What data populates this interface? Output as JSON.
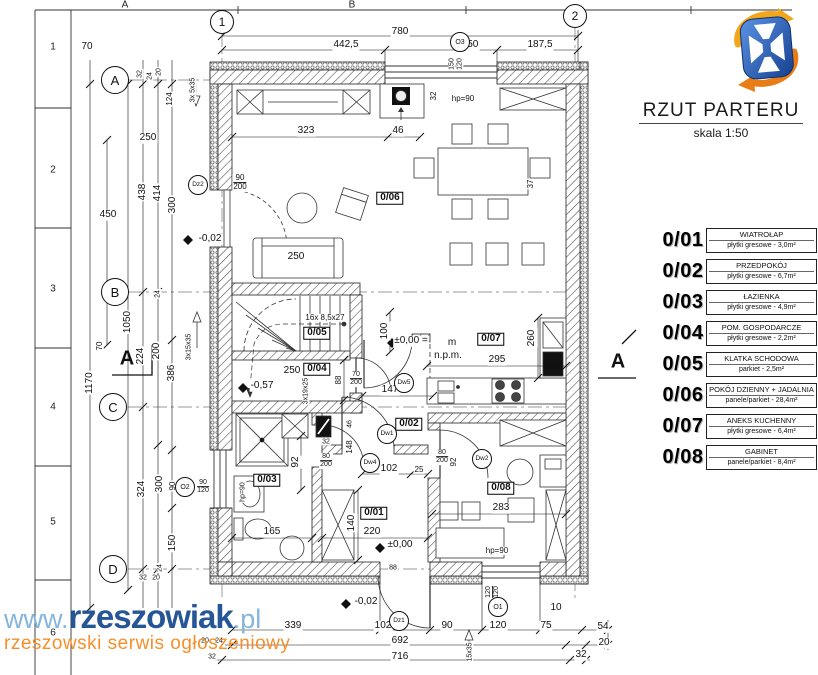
{
  "title_block": {
    "title": "RZUT PARTERU",
    "scale": "skala 1:50"
  },
  "watermark": {
    "www": "www.",
    "name": "rzeszowiak",
    "tld": ".pl",
    "tagline": "rzeszowski serwis ogłoszeniowy"
  },
  "colors": {
    "watermark_blue": "#1b4e91",
    "watermark_light": "#7fb2da",
    "watermark_orange": "#f68a1e",
    "logo_blue_dark": "#16408f",
    "logo_blue_light": "#5b92e5",
    "logo_yellow": "#f2a71b",
    "logo_orange": "#e87d15"
  },
  "legend": {
    "rooms": [
      {
        "id": "0/01",
        "name": "WIATROŁAP",
        "finish": "płytki gresowe - 3,0m²"
      },
      {
        "id": "0/02",
        "name": "PRZEDPOKÓJ",
        "finish": "płytki gresowe - 6,7m²"
      },
      {
        "id": "0/03",
        "name": "ŁAZIENKA",
        "finish": "płytki gresowe - 4,9m²"
      },
      {
        "id": "0/04",
        "name": "POM. GOSPODARCZE",
        "finish": "płytki gresowe - 2,2m²"
      },
      {
        "id": "0/05",
        "name": "KLATKA SCHODOWA",
        "finish": "parkiet - 2,5m²"
      },
      {
        "id": "0/06",
        "name": "POKÓJ DZIENNY + JADALNIA",
        "finish": "panele/parkiet - 28,4m²"
      },
      {
        "id": "0/07",
        "name": "ANEKS KUCHENNY",
        "finish": "płytki gresowe - 6,4m²"
      },
      {
        "id": "0/08",
        "name": "GABINET",
        "finish": "panele/parkiet - 8,4m²"
      }
    ]
  },
  "frame": {
    "top_letters": [
      {
        "t": "A",
        "x": 125
      },
      {
        "t": "B",
        "x": 352
      }
    ],
    "left_numbers": [
      {
        "t": "1",
        "y": 47
      },
      {
        "t": "2",
        "y": 170
      },
      {
        "t": "3",
        "y": 289
      },
      {
        "t": "4",
        "y": 407
      },
      {
        "t": "5",
        "y": 522
      },
      {
        "t": "6",
        "y": 633
      }
    ]
  },
  "plan": {
    "circles": [
      {
        "l": "A",
        "x": 115,
        "y": 80,
        "r": 13,
        "s": 13
      },
      {
        "l": "B",
        "x": 115,
        "y": 292,
        "r": 13,
        "s": 13
      },
      {
        "l": "C",
        "x": 113,
        "y": 407,
        "r": 13,
        "s": 13
      },
      {
        "l": "D",
        "x": 113,
        "y": 569,
        "r": 13,
        "s": 13
      },
      {
        "l": "1",
        "x": 222,
        "y": 22,
        "r": 11,
        "s": 12
      },
      {
        "l": "2",
        "x": 575,
        "y": 16,
        "r": 11,
        "s": 12
      },
      {
        "l": "O3",
        "x": 460,
        "y": 42,
        "r": 9,
        "s": 7
      },
      {
        "l": "O1",
        "x": 498,
        "y": 607,
        "r": 9,
        "s": 7
      },
      {
        "l": "O2",
        "x": 185,
        "y": 487,
        "r": 9,
        "s": 7
      },
      {
        "l": "Dz1",
        "x": 399,
        "y": 621,
        "r": 9,
        "s": 6.5
      },
      {
        "l": "Dz2",
        "x": 198,
        "y": 185,
        "r": 9,
        "s": 6.5
      },
      {
        "l": "Dw1",
        "x": 387,
        "y": 434,
        "r": 9,
        "s": 6.5
      },
      {
        "l": "Dw2",
        "x": 482,
        "y": 459,
        "r": 9,
        "s": 6.5
      },
      {
        "l": "Dw4",
        "x": 370,
        "y": 463,
        "r": 9,
        "s": 6.5
      },
      {
        "l": "Dw5",
        "x": 404,
        "y": 383,
        "r": 9,
        "s": 6.5
      }
    ],
    "labels": [
      {
        "t": "780",
        "x": 400,
        "y": 32
      },
      {
        "t": "442,5",
        "x": 346,
        "y": 45
      },
      {
        "t": "150",
        "x": 470,
        "y": 45
      },
      {
        "t": "187,5",
        "x": 540,
        "y": 45
      },
      {
        "t": "70",
        "x": 87,
        "y": 47
      },
      {
        "t": "150",
        "x": 452,
        "y": 64,
        "r": -90,
        "s": 7
      },
      {
        "t": "120",
        "x": 460,
        "y": 64,
        "r": -90,
        "s": 7
      },
      {
        "t": "32",
        "x": 140,
        "y": 74,
        "r": -90,
        "s": 7
      },
      {
        "t": "24",
        "x": 150,
        "y": 76,
        "r": -90,
        "s": 7
      },
      {
        "t": "20",
        "x": 159,
        "y": 72,
        "r": -90,
        "s": 7
      },
      {
        "t": "124",
        "x": 170,
        "y": 99,
        "r": -90,
        "s": 8
      },
      {
        "t": "3x 5x35",
        "x": 193,
        "y": 90,
        "r": -90,
        "s": 7
      },
      {
        "t": "hp=90",
        "x": 463,
        "y": 99,
        "s": 8
      },
      {
        "t": "32",
        "x": 434,
        "y": 96,
        "r": -90,
        "s": 8
      },
      {
        "t": "323",
        "x": 306,
        "y": 131
      },
      {
        "t": "46",
        "x": 398,
        "y": 131
      },
      {
        "lines": [
          "90",
          "200"
        ],
        "x": 240,
        "y": 183,
        "s": 8
      },
      {
        "t": "0/06",
        "x": 390,
        "y": 198,
        "box": 1
      },
      {
        "t": "250",
        "x": 296,
        "y": 257
      },
      {
        "t": "37",
        "x": 531,
        "y": 184,
        "r": -90,
        "s": 8
      },
      {
        "t": "250",
        "x": 148,
        "y": 138
      },
      {
        "t": "438",
        "x": 143,
        "y": 192,
        "r": -90
      },
      {
        "t": "414",
        "x": 158,
        "y": 193,
        "r": -90
      },
      {
        "t": "300",
        "x": 173,
        "y": 205,
        "r": -90
      },
      {
        "t": "450",
        "x": 108,
        "y": 215
      },
      {
        "t": "-0,02",
        "x": 210,
        "y": 239
      },
      {
        "t": "1050",
        "x": 128,
        "y": 322,
        "r": -90
      },
      {
        "t": "24",
        "x": 158,
        "y": 294,
        "r": -90,
        "s": 7
      },
      {
        "t": "70",
        "x": 100,
        "y": 346,
        "r": -90,
        "s": 8
      },
      {
        "t": "224",
        "x": 141,
        "y": 356,
        "r": -90
      },
      {
        "t": "200",
        "x": 157,
        "y": 351,
        "r": -90
      },
      {
        "t": "386",
        "x": 172,
        "y": 373,
        "r": -90
      },
      {
        "t": "3x15x35",
        "x": 189,
        "y": 347,
        "r": -90,
        "s": 7
      },
      {
        "t": "1170",
        "x": 90,
        "y": 383,
        "r": -90
      },
      {
        "t": "324",
        "x": 142,
        "y": 489,
        "r": -90
      },
      {
        "t": "300",
        "x": 160,
        "y": 484,
        "r": -90
      },
      {
        "t": "90",
        "x": 173,
        "y": 486,
        "r": -90,
        "s": 8
      },
      {
        "lines": [
          "90",
          "120"
        ],
        "x": 203,
        "y": 487,
        "s": 7
      },
      {
        "t": "150",
        "x": 173,
        "y": 543,
        "r": -90
      },
      {
        "t": "24",
        "x": 160,
        "y": 568,
        "r": -90,
        "s": 7
      },
      {
        "t": "32",
        "x": 143,
        "y": 578,
        "s": 7
      },
      {
        "t": "20",
        "x": 156,
        "y": 578,
        "s": 7
      },
      {
        "t": "16x 8,5x27",
        "x": 325,
        "y": 318,
        "s": 8
      },
      {
        "t": "0/05",
        "x": 317,
        "y": 333,
        "box": 1
      },
      {
        "t": "100",
        "x": 385,
        "y": 331,
        "r": -90
      },
      {
        "t": "0/04",
        "x": 317,
        "y": 369,
        "box": 1
      },
      {
        "t": "250",
        "x": 292,
        "y": 371
      },
      {
        "t": "88",
        "x": 339,
        "y": 380,
        "r": -90,
        "s": 8
      },
      {
        "t": "-0,57",
        "x": 262,
        "y": 386
      },
      {
        "t": "3x19x25",
        "x": 306,
        "y": 391,
        "r": -90,
        "s": 7
      },
      {
        "lines": [
          "70",
          "200"
        ],
        "x": 356,
        "y": 379,
        "s": 7
      },
      {
        "t": "±0,00 =",
        "x": 411,
        "y": 341
      },
      {
        "t": "m",
        "x": 452,
        "y": 343
      },
      {
        "t": "n.p.m.",
        "x": 448,
        "y": 356
      },
      {
        "t": "0/07",
        "x": 491,
        "y": 339,
        "box": 1
      },
      {
        "t": "260",
        "x": 532,
        "y": 338,
        "r": -90
      },
      {
        "t": "295",
        "x": 497,
        "y": 360
      },
      {
        "t": "147",
        "x": 390,
        "y": 390
      },
      {
        "t": "0/03",
        "x": 267,
        "y": 480,
        "box": 1
      },
      {
        "t": "hp=90",
        "x": 243,
        "y": 492,
        "r": -90,
        "s": 7
      },
      {
        "t": "92",
        "x": 296,
        "y": 462,
        "r": -90
      },
      {
        "t": "165",
        "x": 272,
        "y": 532
      },
      {
        "lines": [
          "80",
          "200"
        ],
        "x": 326,
        "y": 461,
        "s": 7
      },
      {
        "t": "32",
        "x": 326,
        "y": 442,
        "s": 7
      },
      {
        "t": "46",
        "x": 350,
        "y": 424,
        "r": -90,
        "s": 7
      },
      {
        "t": "148",
        "x": 350,
        "y": 447,
        "r": -90,
        "s": 8
      },
      {
        "t": "140",
        "x": 352,
        "y": 523,
        "r": -90
      },
      {
        "t": "220",
        "x": 372,
        "y": 532
      },
      {
        "t": "0/01",
        "x": 374,
        "y": 513,
        "box": 1
      },
      {
        "t": "102",
        "x": 389,
        "y": 469
      },
      {
        "t": "25",
        "x": 419,
        "y": 470,
        "s": 8
      },
      {
        "t": "±0,00",
        "x": 400,
        "y": 545
      },
      {
        "t": "0/02",
        "x": 409,
        "y": 424,
        "box": 1
      },
      {
        "lines": [
          "80",
          "200"
        ],
        "x": 442,
        "y": 457,
        "s": 7
      },
      {
        "t": "92",
        "x": 454,
        "y": 462,
        "r": -90,
        "s": 8
      },
      {
        "t": "0/08",
        "x": 501,
        "y": 488,
        "box": 1
      },
      {
        "t": "283",
        "x": 501,
        "y": 508
      },
      {
        "t": "hp=90",
        "x": 497,
        "y": 551,
        "s": 8
      },
      {
        "t": "88",
        "x": 393,
        "y": 568,
        "s": 7
      },
      {
        "t": "-0,02",
        "x": 366,
        "y": 602
      },
      {
        "t": "339",
        "x": 293,
        "y": 626
      },
      {
        "t": "102",
        "x": 383,
        "y": 626
      },
      {
        "t": "90",
        "x": 447,
        "y": 626
      },
      {
        "t": "120",
        "x": 498,
        "y": 626
      },
      {
        "t": "75",
        "x": 546,
        "y": 626
      },
      {
        "t": "54",
        "x": 603,
        "y": 627
      },
      {
        "t": "10",
        "x": 556,
        "y": 608
      },
      {
        "t": "20",
        "x": 604,
        "y": 643
      },
      {
        "t": "692",
        "x": 400,
        "y": 641
      },
      {
        "t": "716",
        "x": 400,
        "y": 657
      },
      {
        "t": "32",
        "x": 581,
        "y": 655
      },
      {
        "t": "20",
        "x": 205,
        "y": 641,
        "s": 7
      },
      {
        "t": "24",
        "x": 219,
        "y": 641,
        "s": 7
      },
      {
        "t": "32",
        "x": 212,
        "y": 657,
        "s": 7
      },
      {
        "lines": [
          "120",
          "120"
        ],
        "x": 493,
        "y": 592,
        "s": 7,
        "r": -90
      },
      {
        "t": "15x35",
        "x": 470,
        "y": 652,
        "r": -90,
        "s": 7
      },
      {
        "t": "A",
        "x": 127,
        "y": 359,
        "b": 1,
        "s": 20
      },
      {
        "t": "A",
        "x": 618,
        "y": 362,
        "b": 1,
        "s": 20
      }
    ]
  }
}
